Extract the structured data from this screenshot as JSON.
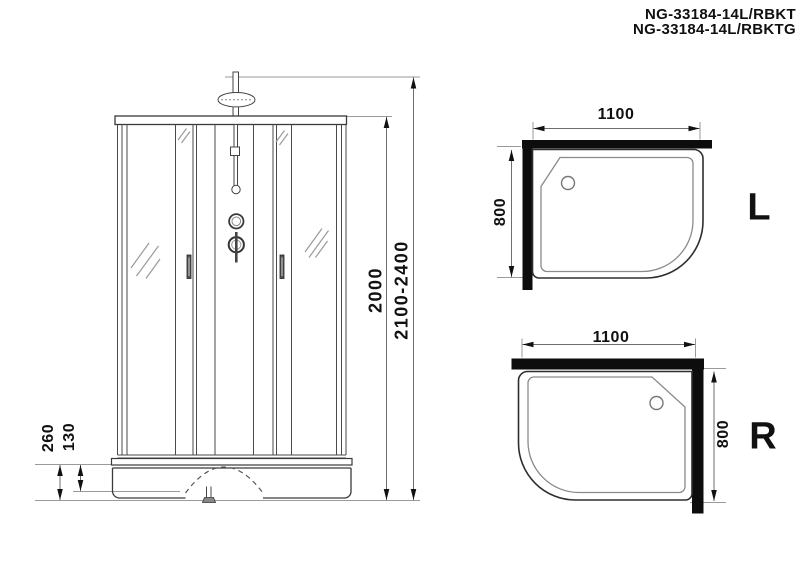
{
  "title": {
    "line1": "NG-33184-14L/RBKT",
    "line2": "NG-33184-14L/RBKTG"
  },
  "front_view": {
    "dim_cabin_height": "2000",
    "dim_total_height": "2100-2400",
    "dim_tray_height": "260",
    "dim_tray_depth": "130"
  },
  "top_view_left": {
    "dim_width": "1100",
    "dim_depth": "800",
    "label": "L"
  },
  "top_view_right": {
    "dim_width": "1100",
    "dim_depth": "800",
    "label": "R"
  },
  "colors": {
    "outline": "#3a3a3a",
    "light_line": "#8a8a8a",
    "dimension_line": "#6e6e6e",
    "wall_bar": "#0d0d0d",
    "text": "#111111",
    "background": "#ffffff"
  }
}
